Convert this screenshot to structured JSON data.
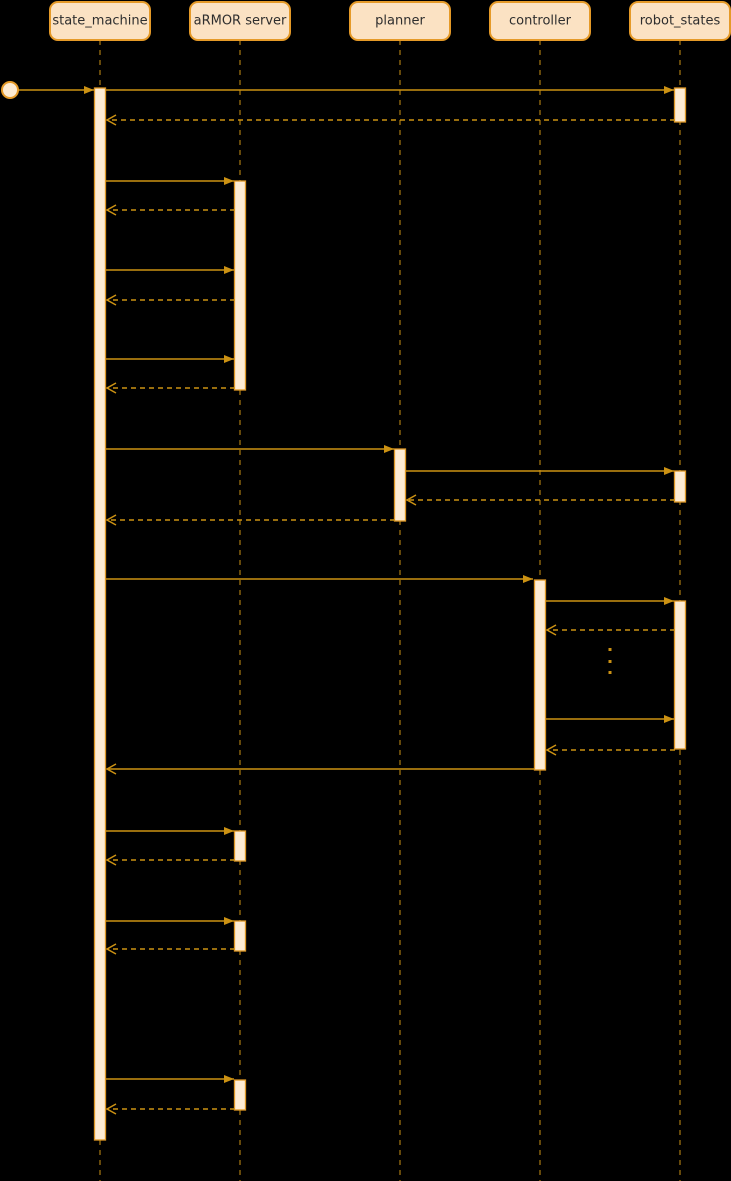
{
  "diagram": {
    "type": "uml-sequence",
    "canvas": {
      "width": 731,
      "height": 1181,
      "background": "#000000"
    },
    "colors": {
      "participant_fill": "#FBE2C3",
      "participant_border": "#E59A28",
      "activation_fill": "#FDEBD3",
      "activation_border": "#DE9725",
      "line": "#CC9213",
      "text": "#2E2E2E"
    },
    "participants": [
      {
        "id": "state-machine",
        "name": "state_machine",
        "x": 100
      },
      {
        "id": "armor-server",
        "name": "aRMOR server",
        "x": 240
      },
      {
        "id": "planner",
        "name": "planner",
        "x": 400
      },
      {
        "id": "controller",
        "name": "controller",
        "x": 540
      },
      {
        "id": "robot-states",
        "name": "robot_states",
        "x": 680
      }
    ],
    "participant_box": {
      "width": 100,
      "top": 2,
      "height": 38,
      "radius": 8
    },
    "lifeline": {
      "top": 40,
      "bottom": 1181
    },
    "start_marker": {
      "x": 10,
      "y": 90,
      "radius": 8
    },
    "activations": [
      {
        "id": "state-machine-activation",
        "cx": 100,
        "y1": 88,
        "y2": 1140
      },
      {
        "id": "robot-states-activation-1",
        "cx": 680,
        "y1": 88,
        "y2": 122
      },
      {
        "id": "armor-server-activation-1",
        "cx": 240,
        "y1": 181,
        "y2": 390
      },
      {
        "id": "planner-activation-1",
        "cx": 400,
        "y1": 449,
        "y2": 521
      },
      {
        "id": "robot-states-activation-2",
        "cx": 680,
        "y1": 471,
        "y2": 502
      },
      {
        "id": "controller-activation-1",
        "cx": 540,
        "y1": 580,
        "y2": 770
      },
      {
        "id": "robot-states-activation-3",
        "cx": 680,
        "y1": 601,
        "y2": 749
      },
      {
        "id": "armor-server-activation-2",
        "cx": 240,
        "y1": 831,
        "y2": 861
      },
      {
        "id": "armor-server-activation-3",
        "cx": 240,
        "y1": 921,
        "y2": 951
      },
      {
        "id": "armor-server-activation-4",
        "cx": 240,
        "y1": 1080,
        "y2": 1110
      }
    ],
    "activation_width": 11,
    "messages": [
      {
        "id": "start-to-state-machine",
        "y": 90,
        "x1": 18,
        "x2": 94,
        "line": "solid",
        "head": "filled"
      },
      {
        "id": "state-machine-to-robot-states",
        "y": 90,
        "x1": 106,
        "x2": 674,
        "line": "solid",
        "head": "filled"
      },
      {
        "id": "robot-states-return-1",
        "y": 120,
        "x1": 675,
        "x2": 107,
        "line": "dashed",
        "head": "open"
      },
      {
        "id": "state-machine-to-armor-1",
        "y": 181,
        "x1": 106,
        "x2": 234,
        "line": "solid",
        "head": "filled"
      },
      {
        "id": "armor-return-1",
        "y": 210,
        "x1": 235,
        "x2": 107,
        "line": "dashed",
        "head": "open"
      },
      {
        "id": "state-machine-to-armor-2",
        "y": 270,
        "x1": 106,
        "x2": 234,
        "line": "solid",
        "head": "filled"
      },
      {
        "id": "armor-return-2",
        "y": 300,
        "x1": 235,
        "x2": 107,
        "line": "dashed",
        "head": "open"
      },
      {
        "id": "state-machine-to-armor-3",
        "y": 359,
        "x1": 106,
        "x2": 234,
        "line": "solid",
        "head": "filled"
      },
      {
        "id": "armor-return-3",
        "y": 388,
        "x1": 235,
        "x2": 107,
        "line": "dashed",
        "head": "open"
      },
      {
        "id": "state-machine-to-planner",
        "y": 449,
        "x1": 106,
        "x2": 394,
        "line": "solid",
        "head": "filled"
      },
      {
        "id": "planner-to-robot-states",
        "y": 471,
        "x1": 406,
        "x2": 674,
        "line": "solid",
        "head": "filled"
      },
      {
        "id": "robot-states-return-to-planner",
        "y": 500,
        "x1": 675,
        "x2": 407,
        "line": "dashed",
        "head": "open"
      },
      {
        "id": "planner-return",
        "y": 520,
        "x1": 395,
        "x2": 107,
        "line": "dashed",
        "head": "open"
      },
      {
        "id": "state-machine-to-controller",
        "y": 579,
        "x1": 106,
        "x2": 533,
        "line": "solid",
        "head": "filled"
      },
      {
        "id": "controller-to-robot-states-1",
        "y": 601,
        "x1": 546,
        "x2": 674,
        "line": "solid",
        "head": "filled"
      },
      {
        "id": "robot-states-return-to-controller-1",
        "y": 630,
        "x1": 675,
        "x2": 547,
        "line": "dashed",
        "head": "open"
      },
      {
        "id": "controller-to-robot-states-2",
        "y": 719,
        "x1": 546,
        "x2": 674,
        "line": "solid",
        "head": "filled"
      },
      {
        "id": "robot-states-return-to-controller-2",
        "y": 750,
        "x1": 675,
        "x2": 547,
        "line": "dashed",
        "head": "open"
      },
      {
        "id": "controller-return",
        "y": 769,
        "x1": 534,
        "x2": 107,
        "line": "solid",
        "head": "open"
      },
      {
        "id": "state-machine-to-armor-4",
        "y": 831,
        "x1": 106,
        "x2": 234,
        "line": "solid",
        "head": "filled"
      },
      {
        "id": "armor-return-4",
        "y": 860,
        "x1": 235,
        "x2": 107,
        "line": "dashed",
        "head": "open"
      },
      {
        "id": "state-machine-to-armor-5",
        "y": 921,
        "x1": 106,
        "x2": 234,
        "line": "solid",
        "head": "filled"
      },
      {
        "id": "armor-return-5",
        "y": 949,
        "x1": 235,
        "x2": 107,
        "line": "dashed",
        "head": "open"
      },
      {
        "id": "state-machine-to-armor-6",
        "y": 1079,
        "x1": 106,
        "x2": 234,
        "line": "solid",
        "head": "filled"
      },
      {
        "id": "armor-return-6",
        "y": 1109,
        "x1": 235,
        "x2": 107,
        "line": "dashed",
        "head": "open"
      }
    ],
    "ellipsis": {
      "x": 610,
      "ys": [
        648,
        660,
        671
      ],
      "size": 3
    }
  }
}
